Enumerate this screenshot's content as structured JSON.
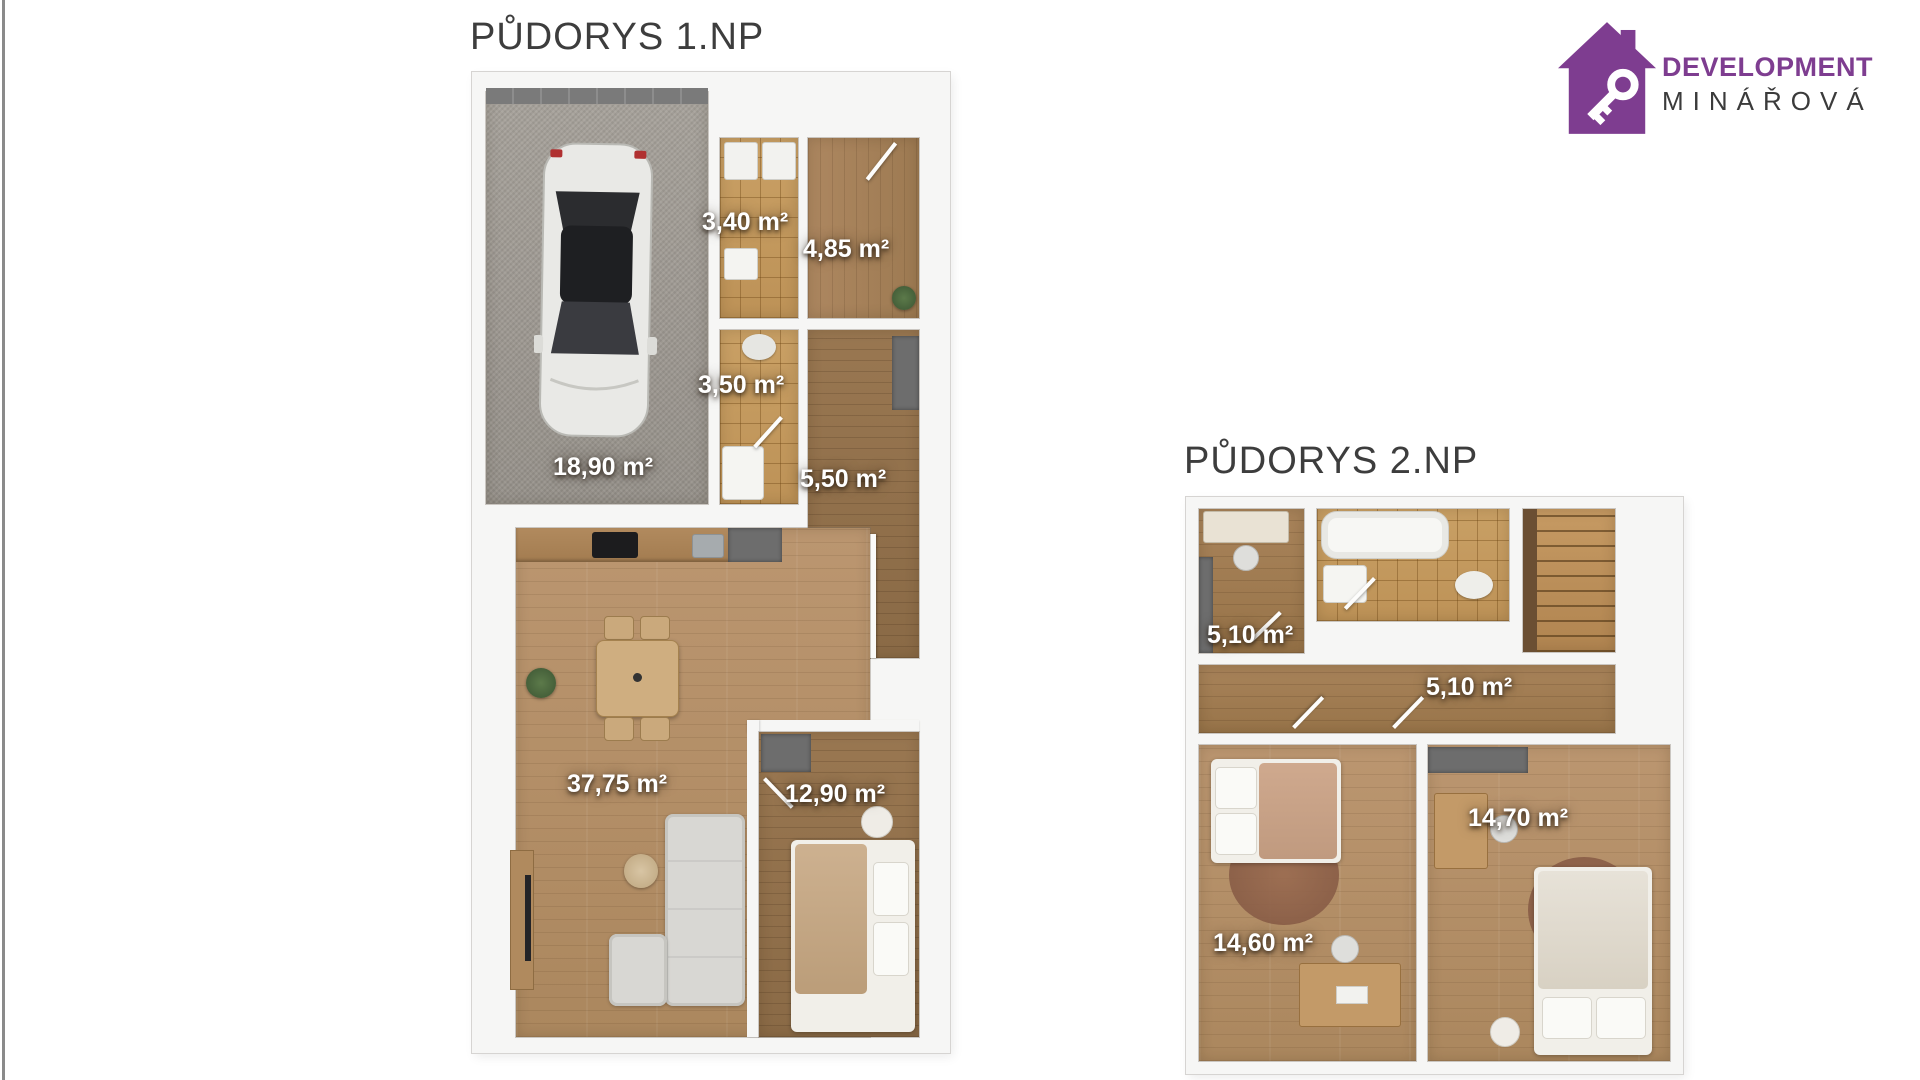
{
  "page": {
    "background": "#ffffff",
    "left_edge_line_color": "#8a8a8a"
  },
  "logo": {
    "icon": "house-with-key-icon",
    "company_line1": "DEVELOPMENT",
    "company_line2": "MINÁŘOVÁ",
    "brand_purple": "#7e3d90",
    "text_dark": "#3b3b3b"
  },
  "floor1": {
    "title": "PŮDORYS 1.NP",
    "rooms": {
      "garage": "18,90 m²",
      "tech": "3,40 m²",
      "entry": "4,85 m²",
      "wc": "3,50 m²",
      "hall": "5,50 m²",
      "living": "37,75 m²",
      "bedroom": "12,90 m²"
    }
  },
  "floor2": {
    "title": "PŮDORYS 2.NP",
    "rooms": {
      "study": "5,10 m²",
      "hall": "5,10 m²",
      "bedroom_right": "14,70 m²",
      "bedroom_left": "14,60 m²"
    }
  }
}
